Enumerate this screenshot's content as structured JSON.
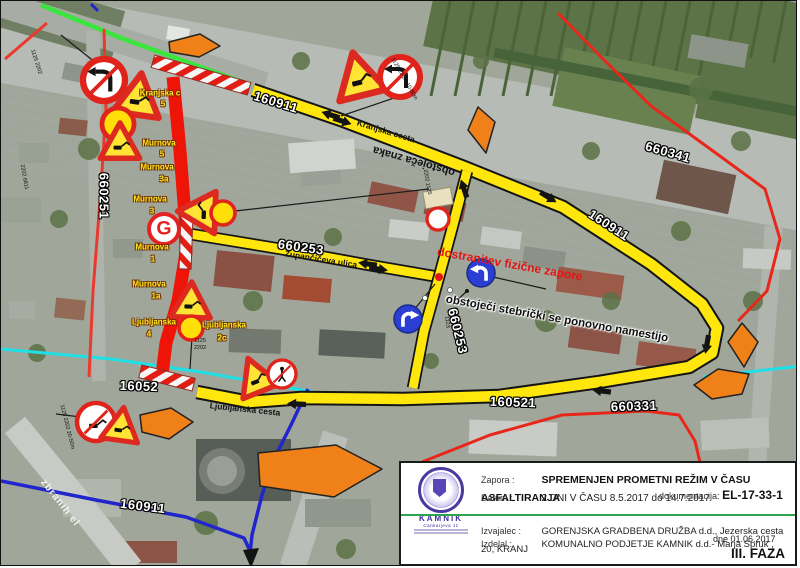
{
  "infobox": {
    "zapora_label": "Zapora :",
    "zapora_value": "SPREMENJEN PROMETNI REŽIM V ČASU ASFALTIRANJA",
    "datum_label": "Datum :",
    "datum_value": "2 DNI V ČASU 8.5.2017 do 14.7.2017",
    "dok_label": "dokumentacija:",
    "dok_value": "EL-17-33-1",
    "izvajalec_label": "Izvajalec :",
    "izvajalec_value": "GORENJSKA GRADBENA DRUŽBA d.d., Jezerska cesta 20, KRANJ",
    "izdelal_label": "Izdelal :",
    "izdelal_value": "KOMUNALNO PODJETJE KAMNIK d.d.- Marja Spruk ,",
    "dne_value": "dne 01.06.2017",
    "faza": "III. FAZA",
    "logo_name": "KAMNIK",
    "logo_address": "Cankarjeva 11"
  },
  "map": {
    "colors": {
      "detour_yellow": "#ffe70d",
      "closed_red": "#ee1408",
      "route_green": "#3ae63e",
      "route_cyan": "#1ee0e6",
      "route_blue": "#2126cc",
      "minor_red": "#e8271b",
      "arrow_orange": "#f08018",
      "sign_red": "#dc2a20",
      "sign_yellow": "#ffdf07",
      "sign_blue": "#2b3fd4"
    },
    "road_lines": [
      {
        "name": "grey-road-band",
        "color": "#c7cac5",
        "w": 26,
        "pts": [
          [
            14,
            424
          ],
          [
            70,
            492
          ],
          [
            130,
            568
          ]
        ]
      },
      {
        "name": "cyan-route-left",
        "color": "#1ee0e6",
        "w": 3,
        "pts": [
          [
            0,
            348
          ],
          [
            110,
            358
          ],
          [
            200,
            371
          ],
          [
            312,
            391
          ]
        ]
      },
      {
        "name": "cyan-route-right",
        "color": "#1ee0e6",
        "w": 3,
        "pts": [
          [
            702,
            376
          ],
          [
            800,
            365
          ]
        ]
      },
      {
        "name": "green-route",
        "color": "#3ae63e",
        "w": 4.5,
        "pts": [
          [
            40,
            4
          ],
          [
            120,
            37
          ],
          [
            205,
            68
          ],
          [
            250,
            84
          ]
        ]
      },
      {
        "name": "blue-route-a",
        "color": "#2126cc",
        "w": 3.5,
        "pts": [
          [
            0,
            480
          ],
          [
            95,
            499
          ],
          [
            185,
            516
          ],
          [
            243,
            537
          ],
          [
            250,
            552
          ]
        ]
      },
      {
        "name": "blue-route-b",
        "color": "#2126cc",
        "w": 3.5,
        "pts": [
          [
            307,
            388
          ],
          [
            290,
            424
          ],
          [
            276,
            452
          ],
          [
            261,
            494
          ],
          [
            251,
            534
          ],
          [
            249,
            553
          ]
        ]
      },
      {
        "name": "red-660251",
        "color": "#ea3a2d",
        "w": 3,
        "pts": [
          [
            103,
            28
          ],
          [
            105,
            110
          ],
          [
            99,
            200
          ],
          [
            92,
            290
          ],
          [
            88,
            376
          ]
        ]
      },
      {
        "name": "red-edge",
        "color": "#ea3a2d",
        "w": 3,
        "pts": [
          [
            4,
            58
          ],
          [
            46,
            22
          ]
        ]
      },
      {
        "name": "red-660341",
        "color": "#e8271b",
        "w": 3,
        "pts": [
          [
            557,
            12
          ],
          [
            602,
            58
          ],
          [
            650,
            105
          ],
          [
            712,
            150
          ],
          [
            764,
            188
          ],
          [
            779,
            238
          ],
          [
            766,
            290
          ],
          [
            737,
            320
          ]
        ]
      },
      {
        "name": "red-660331",
        "color": "#e8271b",
        "w": 3,
        "pts": [
          [
            421,
            461
          ],
          [
            489,
            434
          ],
          [
            561,
            414
          ],
          [
            645,
            410
          ],
          [
            678,
            414
          ],
          [
            694,
            440
          ],
          [
            701,
            470
          ]
        ]
      },
      {
        "name": "detour-loop",
        "color": "#ffe70d",
        "w": 10.5,
        "outline": "#141414",
        "ow": 14.5,
        "pts": [
          [
            252,
            89
          ],
          [
            340,
            119
          ],
          [
            463,
            166
          ],
          [
            562,
            206
          ],
          [
            650,
            263
          ],
          [
            701,
            303
          ],
          [
            716,
            327
          ],
          [
            711,
            352
          ],
          [
            688,
            366
          ],
          [
            598,
            381
          ],
          [
            498,
            395
          ],
          [
            402,
            398
          ],
          [
            300,
            397
          ],
          [
            248,
            401
          ],
          [
            196,
            391
          ]
        ]
      },
      {
        "name": "detour-zupanciceva",
        "color": "#ffe70d",
        "w": 9,
        "outline": "#141414",
        "ow": 12.5,
        "pts": [
          [
            189,
            233
          ],
          [
            280,
            248
          ],
          [
            368,
            264
          ],
          [
            438,
            276
          ]
        ]
      },
      {
        "name": "detour-link",
        "color": "#ffe70d",
        "w": 9,
        "outline": "#141414",
        "ow": 12.5,
        "pts": [
          [
            466,
            170
          ],
          [
            452,
            224
          ],
          [
            438,
            276
          ],
          [
            423,
            330
          ],
          [
            412,
            387
          ]
        ]
      },
      {
        "name": "closed-road-murnova",
        "color": "#ee1408",
        "w": 13,
        "pts": [
          [
            172,
            76
          ],
          [
            179,
            150
          ],
          [
            184,
            215
          ],
          [
            185,
            252
          ],
          [
            177,
            300
          ],
          [
            165,
            342
          ],
          [
            161,
            374
          ]
        ]
      }
    ],
    "barriers": [
      {
        "x": 200,
        "y": 74,
        "len": 100,
        "h": 13,
        "rot": 16
      },
      {
        "x": 185,
        "y": 242,
        "len": 52,
        "h": 12,
        "rot": 92
      },
      {
        "x": 166,
        "y": 377,
        "len": 55,
        "h": 13,
        "rot": 14
      }
    ],
    "traffic_arrows": [
      {
        "x": 330,
        "y": 114,
        "rot": 198
      },
      {
        "x": 341,
        "y": 120,
        "rot": 18
      },
      {
        "x": 463,
        "y": 188,
        "rot": 252
      },
      {
        "x": 547,
        "y": 196,
        "rot": 32
      },
      {
        "x": 367,
        "y": 263,
        "rot": 188
      },
      {
        "x": 377,
        "y": 268,
        "rot": 8
      },
      {
        "x": 706,
        "y": 343,
        "rot": 100
      },
      {
        "x": 601,
        "y": 390,
        "rot": 187
      },
      {
        "x": 296,
        "y": 403,
        "rot": 183
      }
    ],
    "orange_arrows": [
      {
        "name": "orange-arrow-right-top",
        "pts": [
          [
            168,
            41
          ],
          [
            199,
            33
          ],
          [
            219,
            45
          ],
          [
            198,
            56
          ],
          [
            169,
            51
          ]
        ]
      },
      {
        "name": "orange-arrow-down-mid",
        "pts": [
          [
            477,
            106
          ],
          [
            494,
            121
          ],
          [
            485,
            152
          ],
          [
            467,
            129
          ]
        ]
      },
      {
        "name": "orange-arrow-down-right",
        "pts": [
          [
            741,
            322
          ],
          [
            757,
            341
          ],
          [
            743,
            366
          ],
          [
            727,
            341
          ]
        ]
      },
      {
        "name": "orange-arrow-left-right",
        "pts": [
          [
            693,
            384
          ],
          [
            717,
            368
          ],
          [
            748,
            373
          ],
          [
            741,
            393
          ],
          [
            711,
            398
          ]
        ]
      },
      {
        "name": "orange-arrow-right-bottom",
        "pts": [
          [
            257,
            452
          ],
          [
            335,
            444
          ],
          [
            381,
            468
          ],
          [
            333,
            496
          ],
          [
            259,
            485
          ]
        ]
      },
      {
        "name": "orange-arrow-right-small",
        "pts": [
          [
            139,
            414
          ],
          [
            170,
            407
          ],
          [
            192,
            421
          ],
          [
            168,
            438
          ],
          [
            141,
            431
          ]
        ]
      }
    ],
    "blue_arrowhead": [
      [
        242,
        549
      ],
      [
        258,
        547
      ],
      [
        250,
        567
      ]
    ],
    "leader_lines": [
      [
        60,
        34,
        100,
        66
      ],
      [
        396,
        96,
        340,
        115
      ],
      [
        234,
        210,
        428,
        188
      ],
      [
        191,
        336,
        189,
        368
      ],
      [
        55,
        413,
        88,
        417
      ],
      [
        492,
        276,
        545,
        288
      ],
      [
        412,
        310,
        434,
        283
      ],
      [
        466,
        290,
        452,
        303
      ]
    ],
    "dots": [
      {
        "x": 438,
        "y": 276,
        "r": 4,
        "c": "#e61414"
      },
      {
        "x": 449,
        "y": 289,
        "r": 2.5,
        "c": "#ffffff"
      },
      {
        "x": 424,
        "y": 297,
        "r": 2.5,
        "c": "#ffffff"
      },
      {
        "x": 466,
        "y": 290,
        "r": 2,
        "c": "#141414"
      }
    ],
    "signs": [
      {
        "t": "noleft",
        "x": 103,
        "y": 79,
        "r": 21,
        "rot": 0
      },
      {
        "t": "work",
        "x": 137,
        "y": 97,
        "s": 40,
        "rot": 8
      },
      {
        "t": "ycirc",
        "x": 117,
        "y": 123,
        "r": 16,
        "rot": 0
      },
      {
        "t": "work",
        "x": 119,
        "y": 143,
        "s": 34,
        "rot": 0
      },
      {
        "t": "work",
        "x": 358,
        "y": 77,
        "s": 42,
        "rot": -14
      },
      {
        "t": "noleft",
        "x": 399,
        "y": 76,
        "r": 20,
        "rot": 0
      },
      {
        "t": "work",
        "x": 199,
        "y": 211,
        "s": 36,
        "rot": -88
      },
      {
        "t": "ycirc",
        "x": 222,
        "y": 212,
        "r": 12,
        "rot": 0
      },
      {
        "t": "gcirc",
        "x": 163,
        "y": 228,
        "r": 15,
        "rot": 0
      },
      {
        "t": "plate",
        "x": 437,
        "y": 197,
        "w": 28,
        "h": 17,
        "rot": -10
      },
      {
        "t": "wcirc",
        "x": 437,
        "y": 218,
        "r": 11,
        "rot": 0
      },
      {
        "t": "work",
        "x": 190,
        "y": 302,
        "s": 34,
        "rot": 2
      },
      {
        "t": "ycirc",
        "x": 190,
        "y": 327,
        "r": 12,
        "rot": 0
      },
      {
        "t": "work",
        "x": 255,
        "y": 377,
        "s": 34,
        "rot": -22
      },
      {
        "t": "noped",
        "x": 281,
        "y": 373,
        "r": 14,
        "rot": 0
      },
      {
        "t": "nodig",
        "x": 95,
        "y": 421,
        "r": 19,
        "rot": 0
      },
      {
        "t": "work",
        "x": 120,
        "y": 426,
        "s": 32,
        "rot": 8
      },
      {
        "t": "blueL",
        "x": 480,
        "y": 272,
        "r": 14,
        "rot": 0
      },
      {
        "t": "blueR",
        "x": 407,
        "y": 318,
        "r": 14,
        "rot": 0
      }
    ],
    "labels": [
      {
        "t": "Kranjska c",
        "x": 160,
        "y": 93,
        "r": 0,
        "c": "y"
      },
      {
        "t": "5",
        "x": 163,
        "y": 104,
        "r": 0,
        "c": "y"
      },
      {
        "t": "Murnova",
        "x": 159,
        "y": 143,
        "r": 0,
        "c": "y"
      },
      {
        "t": "5",
        "x": 162,
        "y": 154,
        "r": 0,
        "c": "y"
      },
      {
        "t": "Murnova",
        "x": 157,
        "y": 167,
        "r": 0,
        "c": "y"
      },
      {
        "t": "3a",
        "x": 164,
        "y": 179,
        "r": 0,
        "c": "y"
      },
      {
        "t": "Murnova",
        "x": 150,
        "y": 199,
        "r": 0,
        "c": "y"
      },
      {
        "t": "3",
        "x": 152,
        "y": 211,
        "r": 0,
        "c": "y"
      },
      {
        "t": "Murnova",
        "x": 152,
        "y": 247,
        "r": 0,
        "c": "y"
      },
      {
        "t": "1",
        "x": 153,
        "y": 259,
        "r": 0,
        "c": "y"
      },
      {
        "t": "Murnova",
        "x": 149,
        "y": 284,
        "r": 0,
        "c": "y"
      },
      {
        "t": "1a",
        "x": 156,
        "y": 296,
        "r": 0,
        "c": "y"
      },
      {
        "t": "Ljubljanska",
        "x": 154,
        "y": 322,
        "r": 0,
        "c": "y"
      },
      {
        "t": "4",
        "x": 149,
        "y": 334,
        "r": 0,
        "c": "y"
      },
      {
        "t": "Ljubljanska",
        "x": 224,
        "y": 325,
        "r": 0,
        "c": "y"
      },
      {
        "t": "2c",
        "x": 222,
        "y": 338,
        "r": 0,
        "c": "y"
      },
      {
        "t": "Kranjska cesta",
        "x": 386,
        "y": 131,
        "r": 17,
        "c": "st"
      },
      {
        "t": "Župančičeva ulica",
        "x": 321,
        "y": 259,
        "r": 9,
        "c": "st"
      },
      {
        "t": "Ljubljanska cesta",
        "x": 245,
        "y": 409,
        "r": 6,
        "c": "st"
      },
      {
        "t": "obstoječa znaka",
        "x": 414,
        "y": 161,
        "r": 196,
        "c": "flip"
      },
      {
        "t": "dostranitev fizične zapore",
        "x": 510,
        "y": 264,
        "r": 10,
        "c": "red-note"
      },
      {
        "t": "obstoječi stebrički se ponovno namestijo",
        "x": 557,
        "y": 319,
        "r": 10,
        "c": "blk-note"
      },
      {
        "t": "660251",
        "x": 104,
        "y": 196,
        "r": 90,
        "c": "rn"
      },
      {
        "t": "160911",
        "x": 276,
        "y": 102,
        "r": 17,
        "c": "rn"
      },
      {
        "t": "160911",
        "x": 609,
        "y": 225,
        "r": 33,
        "c": "rn"
      },
      {
        "t": "660341",
        "x": 668,
        "y": 152,
        "r": 16,
        "c": "rn"
      },
      {
        "t": "660253",
        "x": 301,
        "y": 247,
        "r": 8,
        "c": "rn"
      },
      {
        "t": "660253",
        "x": 458,
        "y": 331,
        "r": 76,
        "c": "rn"
      },
      {
        "t": "16052",
        "x": 139,
        "y": 386,
        "r": 2,
        "c": "rn"
      },
      {
        "t": "160521",
        "x": 513,
        "y": 402,
        "r": 2,
        "c": "rn"
      },
      {
        "t": "660331",
        "x": 634,
        "y": 406,
        "r": -2,
        "c": "rn"
      },
      {
        "t": "160911",
        "x": 143,
        "y": 506,
        "r": 7,
        "c": "rn"
      },
      {
        "t": "zbranih el",
        "x": 60,
        "y": 503,
        "r": 52,
        "c": "band"
      },
      {
        "t": "1125 2202",
        "x": 36,
        "y": 62,
        "r": 72,
        "c": "tt"
      },
      {
        "t": "1125 22-26 10-50m",
        "x": 404,
        "y": 79,
        "r": 60,
        "c": "tt"
      },
      {
        "t": "2202 1125",
        "x": 427,
        "y": 182,
        "r": 80,
        "c": "tt"
      },
      {
        "t": "1125",
        "x": 200,
        "y": 341,
        "r": 0,
        "c": "tt"
      },
      {
        "t": "2202",
        "x": 200,
        "y": 348,
        "r": 0,
        "c": "tt"
      },
      {
        "t": "1125 2202 20-50m",
        "x": 67,
        "y": 427,
        "r": 76,
        "c": "tt"
      },
      {
        "t": "2202 6811",
        "x": 24,
        "y": 177,
        "r": 80,
        "c": "tt"
      },
      {
        "t": "1123",
        "x": 447,
        "y": 322,
        "r": 84,
        "c": "tt"
      }
    ]
  }
}
